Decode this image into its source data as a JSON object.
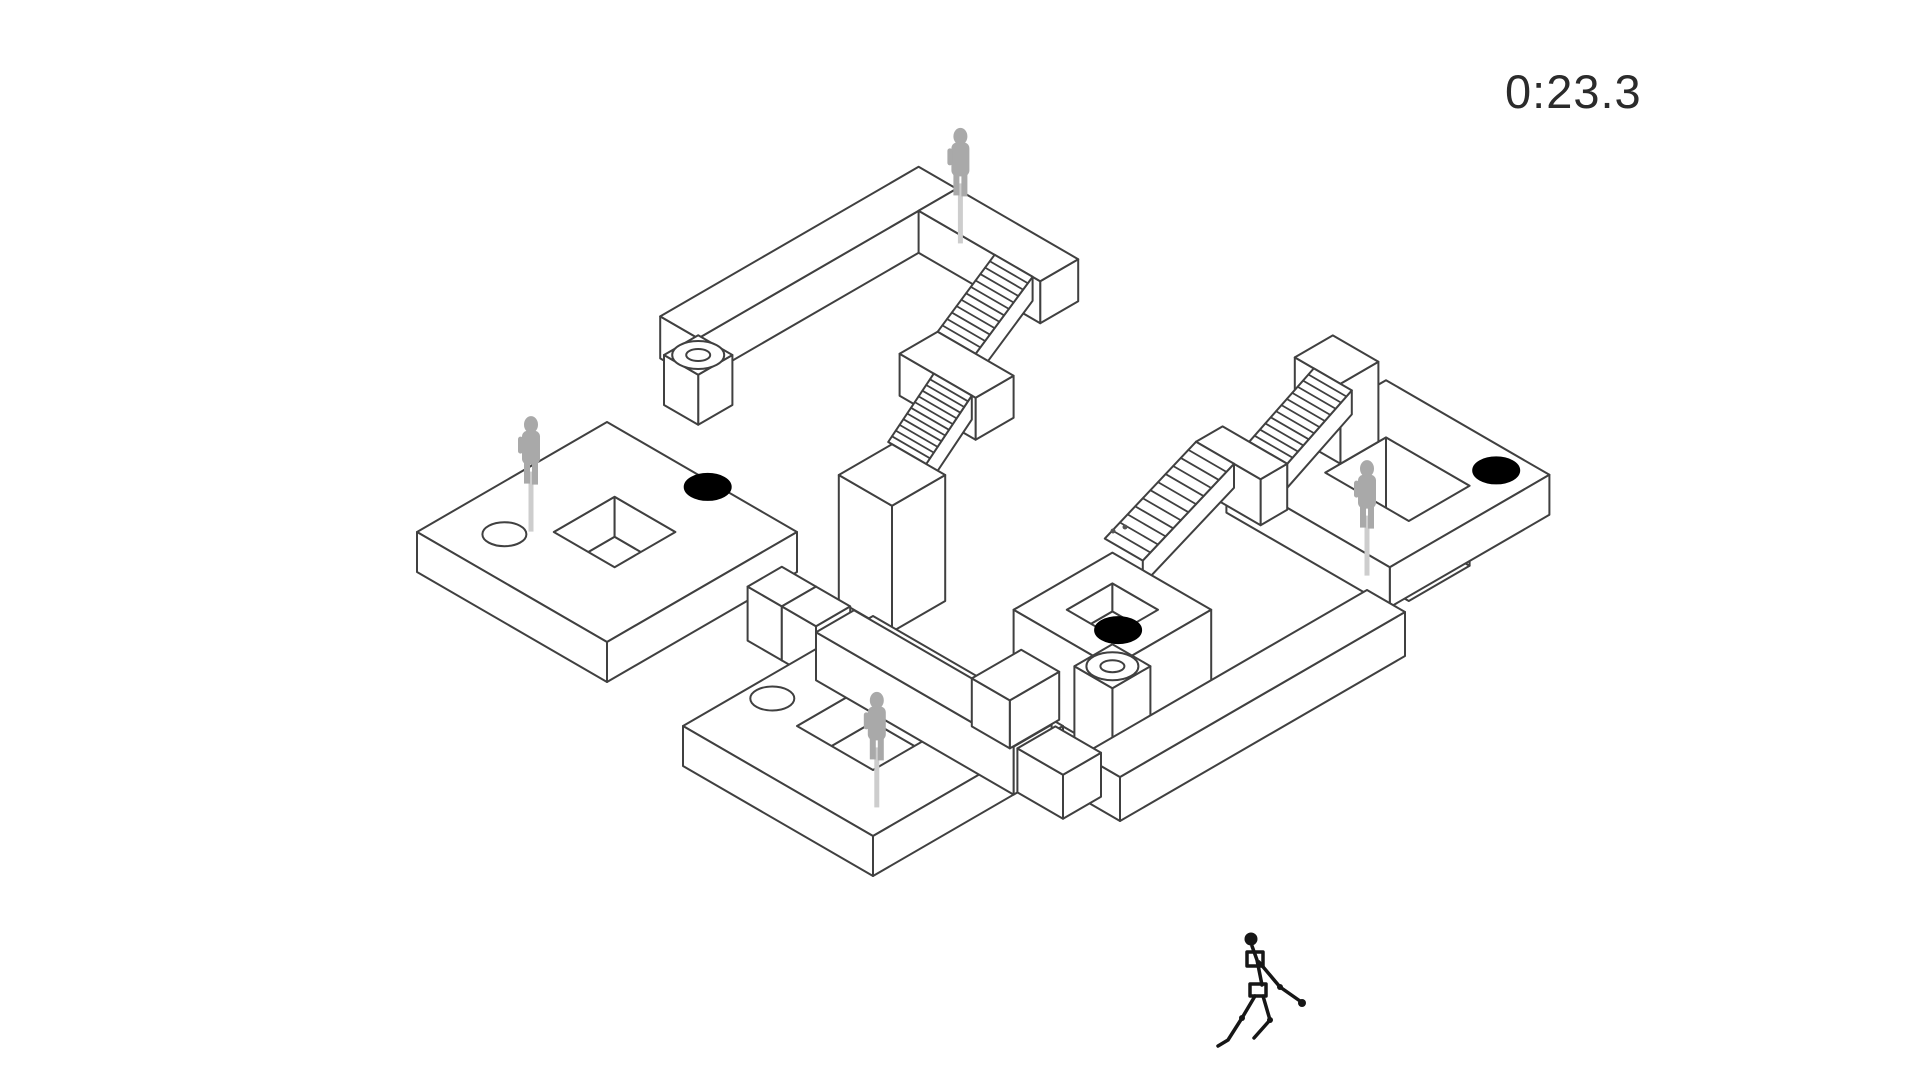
{
  "hud": {
    "timer": "0:23.3"
  },
  "colors": {
    "background": "#ffffff",
    "line": "#404040",
    "surface": "#ffffff",
    "ghost": "#a9a9a9",
    "ghost_streak": "#cdcdcd",
    "hole_black": "#000000",
    "timer_text": "#2b2b2b",
    "player": "#161616",
    "speck": "#555555"
  },
  "scene": {
    "shapes": [
      {
        "type": "box",
        "name": "upper-walkway-long",
        "u": [
          1.3,
          2.3
        ],
        "v": [
          -6.9,
          -0.1
        ],
        "z": 172,
        "h": 42
      },
      {
        "type": "box",
        "name": "upper-walkway-short",
        "u": [
          2.3,
          5.5
        ],
        "v": [
          -6.9,
          -5.9
        ],
        "z": 172,
        "h": 42
      },
      {
        "type": "ghost",
        "name": "ghost-upper-walkway",
        "at": [
          2.5,
          -6.8
        ],
        "z": 172
      },
      {
        "type": "stairs",
        "name": "upper-stairs-flight-1",
        "u": [
          4.3,
          5.3
        ],
        "v0": -5.9,
        "z0": 172,
        "v1": -4.4,
        "z1": 128
      },
      {
        "type": "box",
        "name": "upper-stairs-landing",
        "u": [
          4.3,
          6.3
        ],
        "v": [
          -4.4,
          -3.4
        ],
        "z": 128,
        "h": 42
      },
      {
        "type": "stairs",
        "name": "upper-stairs-flight-2",
        "u": [
          5.2,
          6.2
        ],
        "v0": -3.4,
        "z0": 128,
        "v1": -2.2,
        "z1": 86
      },
      {
        "type": "box",
        "name": "center-pillar",
        "u": [
          5.3,
          6.7
        ],
        "v": [
          -2.2,
          -0.8
        ],
        "z": 86,
        "h": 126
      },
      {
        "type": "box",
        "name": "pedestal-column",
        "u": [
          1.5,
          2.4
        ],
        "v": [
          -0.9,
          0.0
        ],
        "z": 140,
        "h": 50
      },
      {
        "type": "ringhole",
        "name": "pedestal-ring-hole",
        "at": [
          1.95,
          -0.45
        ],
        "z": 140
      },
      {
        "type": "ringplat",
        "name": "right-platform",
        "u": [
          9.3,
          13.6
        ],
        "v": [
          -11.2,
          -7.0
        ],
        "z": 40,
        "h": 40,
        "hole": [
          10.6,
          -9.9,
          12.8,
          -8.3
        ],
        "floor": -40
      },
      {
        "type": "box",
        "name": "right-platform-high-wall",
        "u": [
          9.4,
          10.6
        ],
        "v": [
          -9.7,
          -8.7
        ],
        "z": 120,
        "h": 80
      },
      {
        "type": "stairs",
        "name": "right-stairs-upper",
        "u": [
          9.9,
          10.9
        ],
        "v0": -8.7,
        "z0": 120,
        "v1": -7.0,
        "z1": 84
      },
      {
        "type": "box",
        "name": "right-stairs-landing",
        "u": [
          9.2,
          10.9
        ],
        "v": [
          -7.0,
          -6.3
        ],
        "z": 84,
        "h": 46
      },
      {
        "type": "stairs",
        "name": "right-stairs-lower",
        "u": [
          9.2,
          10.2
        ],
        "v0": -6.3,
        "z0": 84,
        "v1": -3.9,
        "z1": 40
      },
      {
        "type": "hole",
        "name": "black-hole-right",
        "at": [
          12.8,
          -10.6
        ],
        "z": 40,
        "variant": "black"
      },
      {
        "type": "ghost",
        "name": "ghost-right-platform",
        "at": [
          12.4,
          -7.6
        ],
        "z": 40
      },
      {
        "type": "ringplat",
        "name": "left-platform",
        "u": [
          0,
          5
        ],
        "v": [
          0,
          5
        ],
        "z": 40,
        "h": 40,
        "hole": [
          1.8,
          1.6,
          3.4,
          3.2
        ],
        "floor": 0
      },
      {
        "type": "hole",
        "name": "black-hole-left",
        "at": [
          2.8,
          0.15
        ],
        "z": 40,
        "variant": "black"
      },
      {
        "type": "hole",
        "name": "white-hole-left",
        "at": [
          1.2,
          3.9
        ],
        "z": 40,
        "variant": "white"
      },
      {
        "type": "ghost",
        "name": "ghost-left-platform",
        "at": [
          0.4,
          2.4
        ],
        "z": 40
      },
      {
        "type": "box",
        "name": "bridge-cube-1",
        "u": [
          5.0,
          5.9
        ],
        "v": [
          0.4,
          1.3
        ],
        "z": 14,
        "h": 54
      },
      {
        "type": "box",
        "name": "bridge-cube-2",
        "u": [
          5.9,
          6.8
        ],
        "v": [
          0.4,
          1.3
        ],
        "z": 14,
        "h": 54
      },
      {
        "type": "ringplat",
        "name": "mid-courtyard",
        "u": [
          9.8,
          12.4
        ],
        "v": [
          -3.5,
          -0.9
        ],
        "z": 48,
        "h": 88,
        "hole": [
          10.5,
          -2.8,
          11.7,
          -1.6
        ],
        "floor": 20
      },
      {
        "type": "hole",
        "name": "black-hole-mid",
        "at": [
          11.0,
          -2.45
        ],
        "z": 20,
        "variant": "black"
      },
      {
        "type": "box",
        "name": "mid-column",
        "u": [
          11.7,
          12.7
        ],
        "v": [
          -1.6,
          -0.6
        ],
        "z": 40,
        "h": 80
      },
      {
        "type": "ringhole",
        "name": "column-ring-hole",
        "at": [
          12.2,
          -1.1
        ],
        "z": 40
      },
      {
        "type": "ringplat",
        "name": "bottom-platform",
        "u": [
          7,
          12
        ],
        "v": [
          0,
          5
        ],
        "z": 0,
        "h": 40,
        "hole": [
          8.5,
          1.5,
          10.5,
          3.5
        ],
        "floor": -40
      },
      {
        "type": "box",
        "name": "rim-walkway",
        "u": [
          6.8,
          12.0
        ],
        "v": [
          0.3,
          1.3
        ],
        "z": 8,
        "h": 48
      },
      {
        "type": "box",
        "name": "rim-connector",
        "u": [
          9.9,
          10.9
        ],
        "v": [
          -1.0,
          0.3
        ],
        "z": 8,
        "h": 48
      },
      {
        "type": "box",
        "name": "low-walkway",
        "u": [
          13.0,
          14.0
        ],
        "v": [
          -7.0,
          0.5
        ],
        "z": 4,
        "h": 44
      },
      {
        "type": "box",
        "name": "low-connector",
        "u": [
          12.0,
          13.2
        ],
        "v": [
          0.2,
          1.2
        ],
        "z": 4,
        "h": 44
      },
      {
        "type": "hole",
        "name": "white-hole-bottom",
        "at": [
          7.55,
          3.2
        ],
        "z": 0,
        "variant": "white"
      },
      {
        "type": "ghost",
        "name": "ghost-bottom-courtyard",
        "at": [
          9.4,
          2.3
        ],
        "z": -40
      },
      {
        "type": "speck",
        "name": "speck-1",
        "px": [
          1113,
          531
        ]
      },
      {
        "type": "speck",
        "name": "speck-2",
        "px": [
          1125,
          527
        ]
      }
    ],
    "player": {
      "x": 1262,
      "y": 1042
    }
  }
}
